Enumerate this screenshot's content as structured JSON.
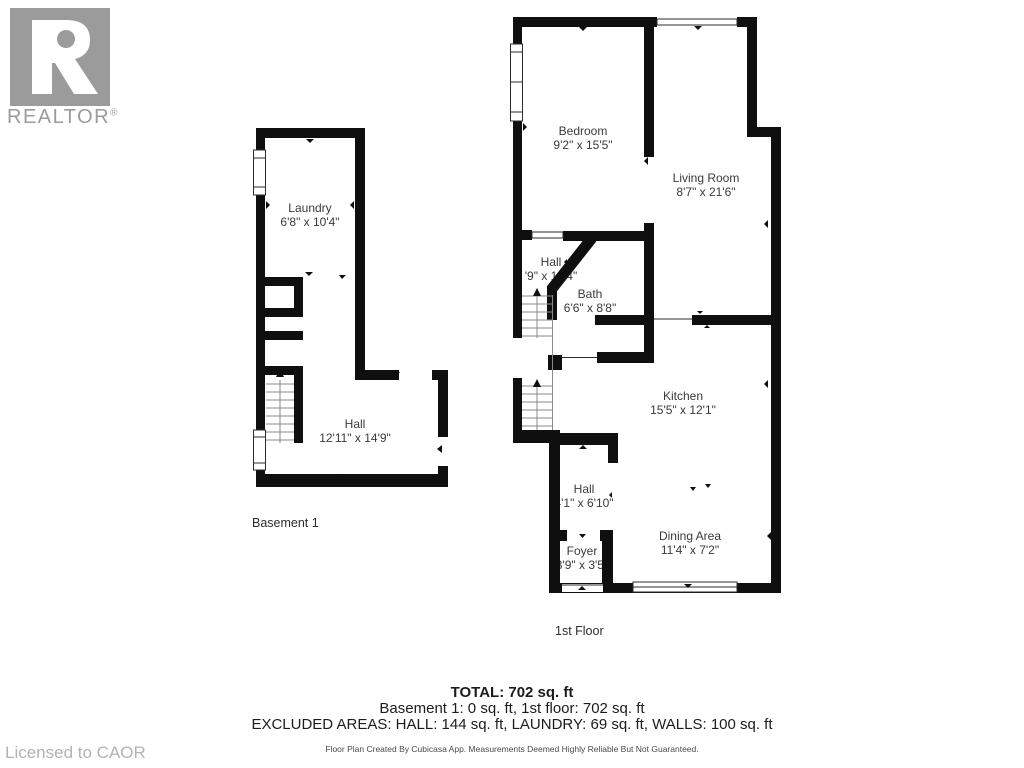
{
  "branding": {
    "logo_text": "REALTOR",
    "registered": "®",
    "license": "Licensed to CAOR",
    "logo_color": "#9b9b9b"
  },
  "colors": {
    "wall": "#0f0f0f",
    "room_label": "#3a3a3a",
    "stairs": "#8a8a8a",
    "license_text": "#b0b3b8"
  },
  "floors": {
    "basement": {
      "label": "Basement 1",
      "rooms": [
        {
          "name": "Laundry",
          "dims": "6'8\" x 10'4\""
        },
        {
          "name": "Hall",
          "dims": "12'11\" x 14'9\""
        }
      ]
    },
    "first": {
      "label": "1st Floor",
      "rooms": [
        {
          "name": "Bedroom",
          "dims": "9'2\" x 15'5\""
        },
        {
          "name": "Living Room",
          "dims": "8'7\" x 21'6\""
        },
        {
          "name": "Hall",
          "dims": "'9\" x 10'4\""
        },
        {
          "name": "Bath",
          "dims": "6'6\" x 8'8\""
        },
        {
          "name": "Kitchen",
          "dims": "15'5\" x 12'1\""
        },
        {
          "name": "Hall",
          "dims": "4'1\" x 6'10\""
        },
        {
          "name": "Foyer",
          "dims": "3'9\" x 3'5\""
        },
        {
          "name": "Dining Area",
          "dims": "11'4\" x 7'2\""
        }
      ]
    }
  },
  "summary": {
    "total": "TOTAL: 702 sq. ft",
    "by_floor": "Basement 1: 0 sq. ft, 1st floor: 702 sq. ft",
    "excluded": "EXCLUDED AREAS: HALL: 144 sq. ft, LAUNDRY: 69 sq. ft, WALLS: 100 sq. ft",
    "disclaimer": "Floor Plan Created By Cubicasa App. Measurements Deemed Highly Reliable But Not Guaranteed."
  }
}
